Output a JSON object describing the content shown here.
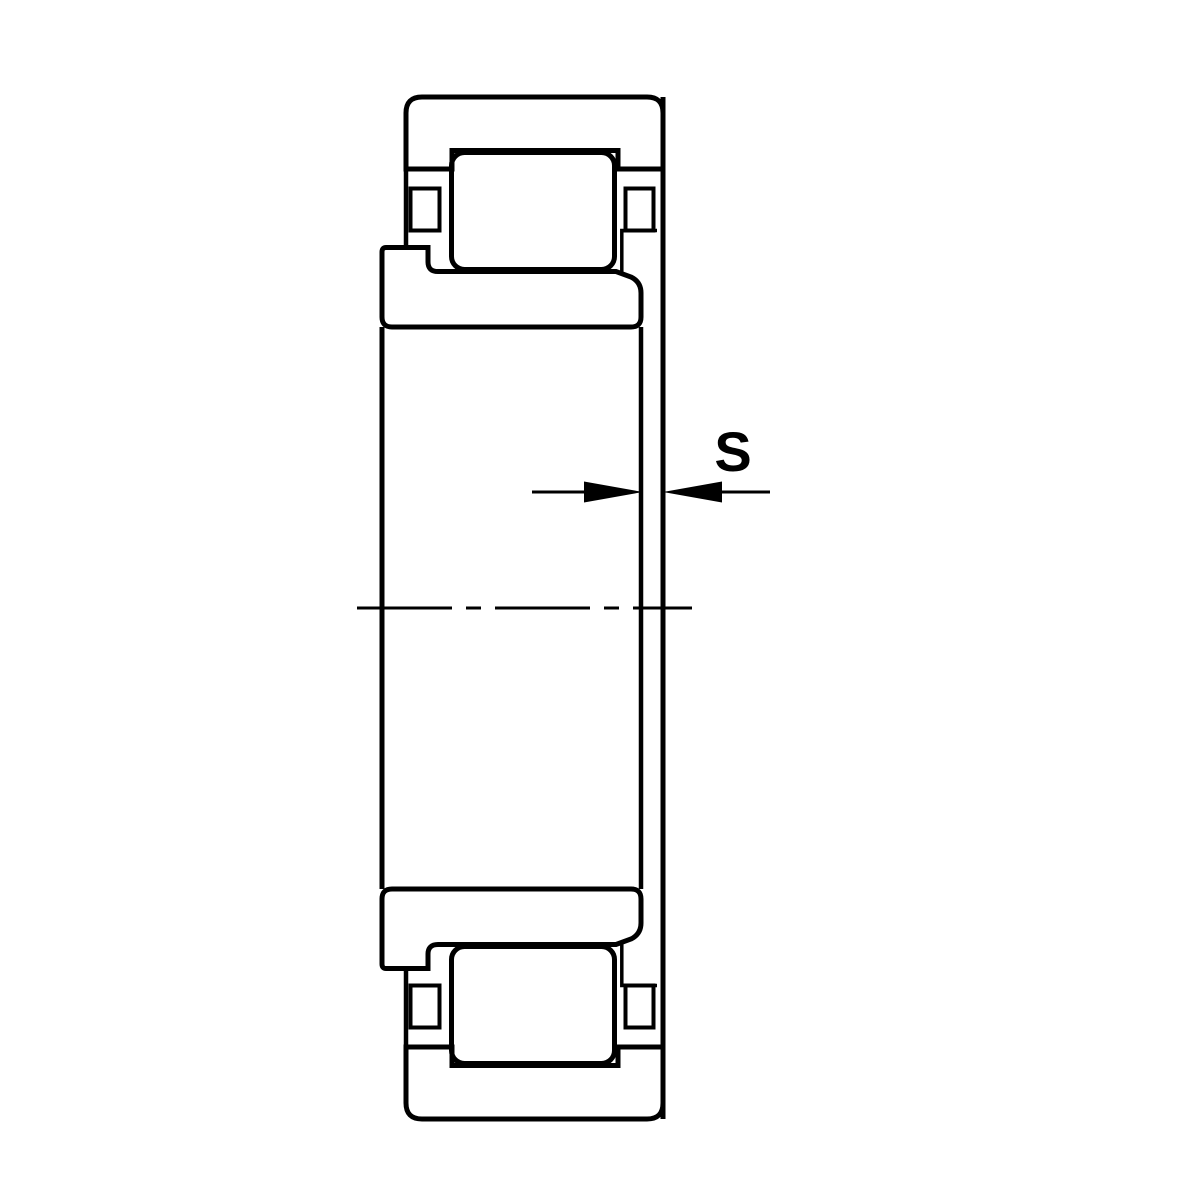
{
  "drawing": {
    "dimension_label": "S",
    "ink_color": "#000000",
    "background_color": "#ffffff"
  }
}
